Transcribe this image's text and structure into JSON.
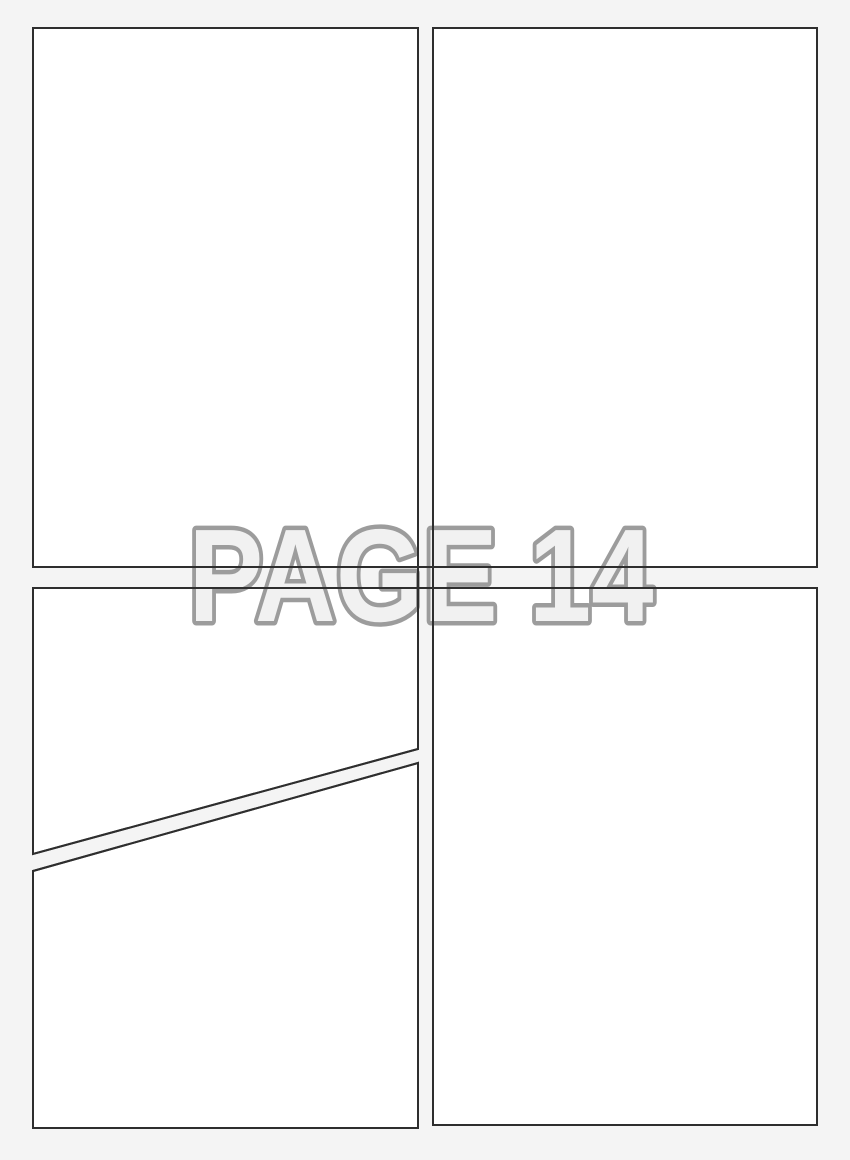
{
  "page": {
    "label": "PAGE 14"
  },
  "colors": {
    "background": "#f4f4f4",
    "panel_fill": "#ffffff",
    "panel_border": "#2e2e2e",
    "label_fill": "#f1f1f1",
    "label_outline": "#9c9c9c"
  },
  "panels": [
    {
      "id": "top-left"
    },
    {
      "id": "top-right"
    },
    {
      "id": "bottom-left-upper"
    },
    {
      "id": "bottom-left-lower"
    },
    {
      "id": "bottom-right"
    }
  ]
}
